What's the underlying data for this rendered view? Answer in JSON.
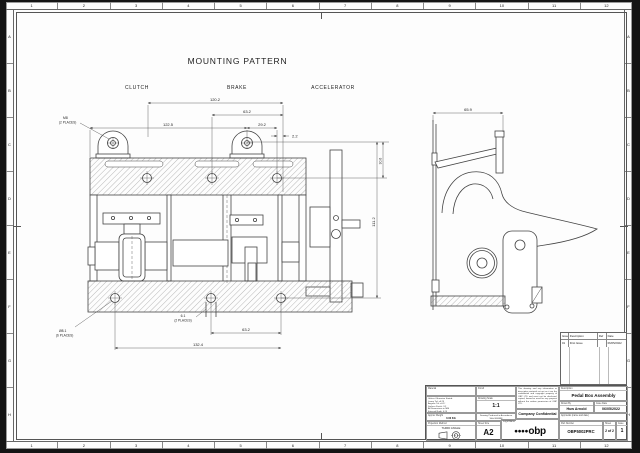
{
  "border_ruler": {
    "columns": [
      "1",
      "2",
      "3",
      "4",
      "5",
      "6",
      "7",
      "8",
      "9",
      "10",
      "11",
      "12"
    ],
    "rows": [
      "A",
      "B",
      "C",
      "D",
      "E",
      "F",
      "G",
      "H"
    ]
  },
  "drawing": {
    "title": "MOUNTING PATTERN",
    "labels": {
      "clutch": "CLUTCH",
      "brake": "BRAKE",
      "accelerator": "ACCELERATOR"
    }
  },
  "front_view": {
    "dims": {
      "overall_top": "120.2",
      "upper": "63.2",
      "lug_span": "122.5",
      "offset": "29.2",
      "edge": "2.2",
      "height": "111.2",
      "lug_height": "30.6",
      "bottom_mid": "63.2",
      "bottom_span": "132.4",
      "slot": "6.1",
      "slot_note": "(2 PLACES)",
      "top_left_callout": "M8",
      "top_left_note": "(2 PLACES)",
      "bottom_left_callout": "Ø8.1",
      "bottom_left_note": "(6 PLACES)"
    }
  },
  "side_view": {
    "dims": {
      "width": "65.9"
    }
  },
  "revision_table": {
    "headers": [
      "Issue",
      "Description",
      "Ref",
      "Date"
    ],
    "rows": [
      {
        "issue": "01",
        "description": "First Issue",
        "ref": "",
        "date": "06/05/2022"
      }
    ]
  },
  "title_block": {
    "material_label": "Material",
    "finish_label": "Finish",
    "tolerance_note": "Unless Otherwise Stated:\nLinear Tol: ±0.25\nAngular Tol: ±0.5°\nSurface Finish: 3.2\nAll Dimensions in MM\nExternal Radii: 0.25\nInternal Radii: 0.25\nBREAK ALL SHARP EDGES",
    "scale_label": "Drawing Scale",
    "scale_value": "1:1",
    "weight_label": "Approx Weight",
    "weight_value": "0.00 KG",
    "standard_note": "Drawing Produced in Accordance With BS8888",
    "projection_label": "Projection Method",
    "projection_value": "THIRD ANGLE",
    "sheet_size_label": "Sheet Size",
    "sheet_size_value": "A2",
    "confidential_note": "This drawing and any information or descriptive material set out on it are the confidential and copyright property of OBP LTD and must not be disclosed, copied, loaned or used for any purpose without the written permission of OBP LTD.",
    "company_confidential": "Company Confidential",
    "logo_label": "Logo/Name",
    "logo_dots": "●●●●",
    "logo_text": "obp",
    "description_label": "Description",
    "description_value": "Pedal Box Assembly",
    "drawn_by_label": "Drawn By",
    "drawn_by_value": "Huw Arnold",
    "date_label": "Issue Date",
    "date_value": "06/05/2022",
    "approvals_label": "Approvals (name and date)",
    "part_number_label": "Part Number",
    "part_number_value": "OBP5002PRC",
    "sheet_label": "Sheet",
    "sheet_value": "2 of 2",
    "issue_label": "Issue",
    "issue_value": "1"
  }
}
